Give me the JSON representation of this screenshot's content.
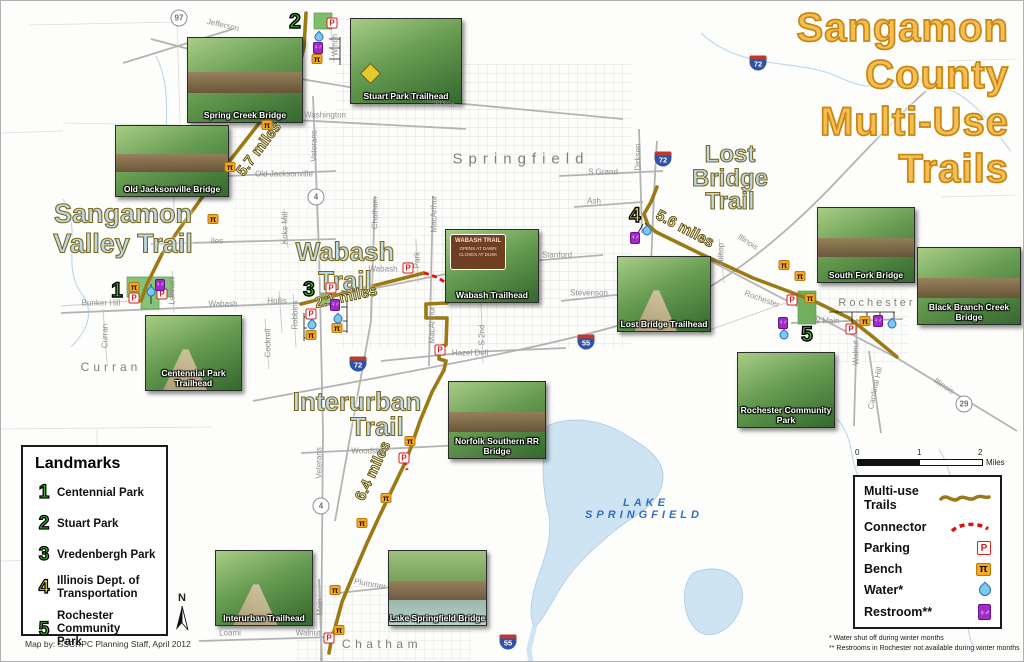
{
  "title": {
    "line1": "Sangamon",
    "line2": "County",
    "line3": "Multi-Use",
    "line4": "Trails"
  },
  "trails": {
    "sangamon_valley": {
      "name_line1": "Sangamon",
      "name_line2": "Valley Trail",
      "miles": "5.7 miles"
    },
    "wabash": {
      "name_line1": "Wabash",
      "name_line2": "Trail",
      "miles": "2.1 miles"
    },
    "lost_bridge": {
      "name_line1": "Lost",
      "name_line2": "Bridge",
      "name_line3": "Trail",
      "miles": "5.6 miles"
    },
    "interurban": {
      "name_line1": "Interurban",
      "name_line2": "Trail",
      "miles": "6.4 miles"
    }
  },
  "cities": {
    "springfield": "Springfield",
    "curran": "Curran",
    "chatham": "Chatham",
    "rochester": "Rochester",
    "lake_line1": "LAKE",
    "lake_line2": "SPRINGFIELD"
  },
  "roads": {
    "jefferson": "Jefferson",
    "washington": "Washington",
    "old_jacksonville": "Old Jacksonville",
    "iles": "Iles",
    "wabash": "Wabash",
    "hollis": "Hollis",
    "robbins": "Robbins",
    "bunker_hill": "Bunker Hill",
    "curran": "Curran",
    "lenhart": "Lenhart",
    "cockrell": "Cockrell",
    "veterans": "Veterans",
    "koke_mill": "Koke Mill",
    "winch": "Winch",
    "chatham": "Chatham",
    "macarthur": "MacArthur",
    "park": "Park",
    "s_2nd": "S 2nd",
    "hazel_dell": "Hazel Dell",
    "s_grand": "S Grand",
    "ash": "Ash",
    "stanford": "Stanford",
    "stevenson": "Stevenson",
    "dirksen": "Dirksen",
    "illinois": "Illinois",
    "hilltop": "Hilltop",
    "rochester": "Rochester",
    "w_main": "W Main",
    "walnut": "Walnut",
    "cardinal_hill": "Cardinal Hill",
    "woodside": "Woodside",
    "plummer": "Plummer",
    "main": "Main",
    "loami": "Loami"
  },
  "shields": {
    "r97": "97",
    "r4": "4",
    "r29": "29",
    "i72": "72",
    "i55": "55"
  },
  "landmark_markers": {
    "m1": "1",
    "m2": "2",
    "m3": "3",
    "m4": "4",
    "m5": "5"
  },
  "photos": [
    {
      "caption": "Spring Creek Bridge"
    },
    {
      "caption": "Stuart Park Trailhead"
    },
    {
      "caption": "Old Jacksonville Bridge"
    },
    {
      "caption": "Centennial Park Trailhead"
    },
    {
      "caption": "Wabash Trailhead"
    },
    {
      "caption": "Norfolk Southern RR Bridge"
    },
    {
      "caption": "Lost Bridge Trailhead"
    },
    {
      "caption": "South Fork Bridge"
    },
    {
      "caption": "Black Branch Creek Bridge"
    },
    {
      "caption": "Rochester Community Park"
    },
    {
      "caption": "Interurban Trailhead"
    },
    {
      "caption": "Lake Springfield Bridge"
    }
  ],
  "wabash_sign": {
    "line1": "WABASH TRAIL",
    "line2": "OPENS AT DAWN",
    "line3": "CLOSES AT DUSK"
  },
  "landmarks_panel": {
    "title": "Landmarks",
    "items": [
      {
        "num": "1",
        "label": "Centennial Park"
      },
      {
        "num": "2",
        "label": "Stuart Park"
      },
      {
        "num": "3",
        "label": "Vredenbergh Park"
      },
      {
        "num": "4",
        "label": "Illinois Dept. of Transportation"
      },
      {
        "num": "5",
        "label": "Rochester Community Park"
      }
    ]
  },
  "credit": "Map by: SSCRPC Planning Staff, April 2012",
  "north_label": "N",
  "legend_panel": {
    "items": [
      {
        "label": "Multi-use Trails",
        "icon": "trail-line"
      },
      {
        "label": "Connector",
        "icon": "connector-dashes"
      },
      {
        "label": "Parking",
        "icon": "parking"
      },
      {
        "label": "Bench",
        "icon": "bench"
      },
      {
        "label": "Water*",
        "icon": "water"
      },
      {
        "label": "Restroom**",
        "icon": "restroom"
      }
    ]
  },
  "scale_bar": {
    "t0": "0",
    "t1": "1",
    "t2": "2",
    "unit": "Miles"
  },
  "footnotes": {
    "line1": "* Water shut off during winter months",
    "line2": "** Restrooms in Rochester not available during winter months"
  },
  "icon_glyphs": {
    "parking": "P",
    "bench": "π",
    "restroom": "♀♂"
  },
  "colors": {
    "trail": "#9b7a15",
    "connector": "#e01010",
    "title_fill": "#f5bd55",
    "title_outline": "#c8870e",
    "water_blue": "#7ec7f0",
    "restroom_purple": "#a02cc8",
    "bench_orange": "#f9a825",
    "park_green": "#7dbf6e",
    "lake_blue": "#cfe4f2"
  }
}
